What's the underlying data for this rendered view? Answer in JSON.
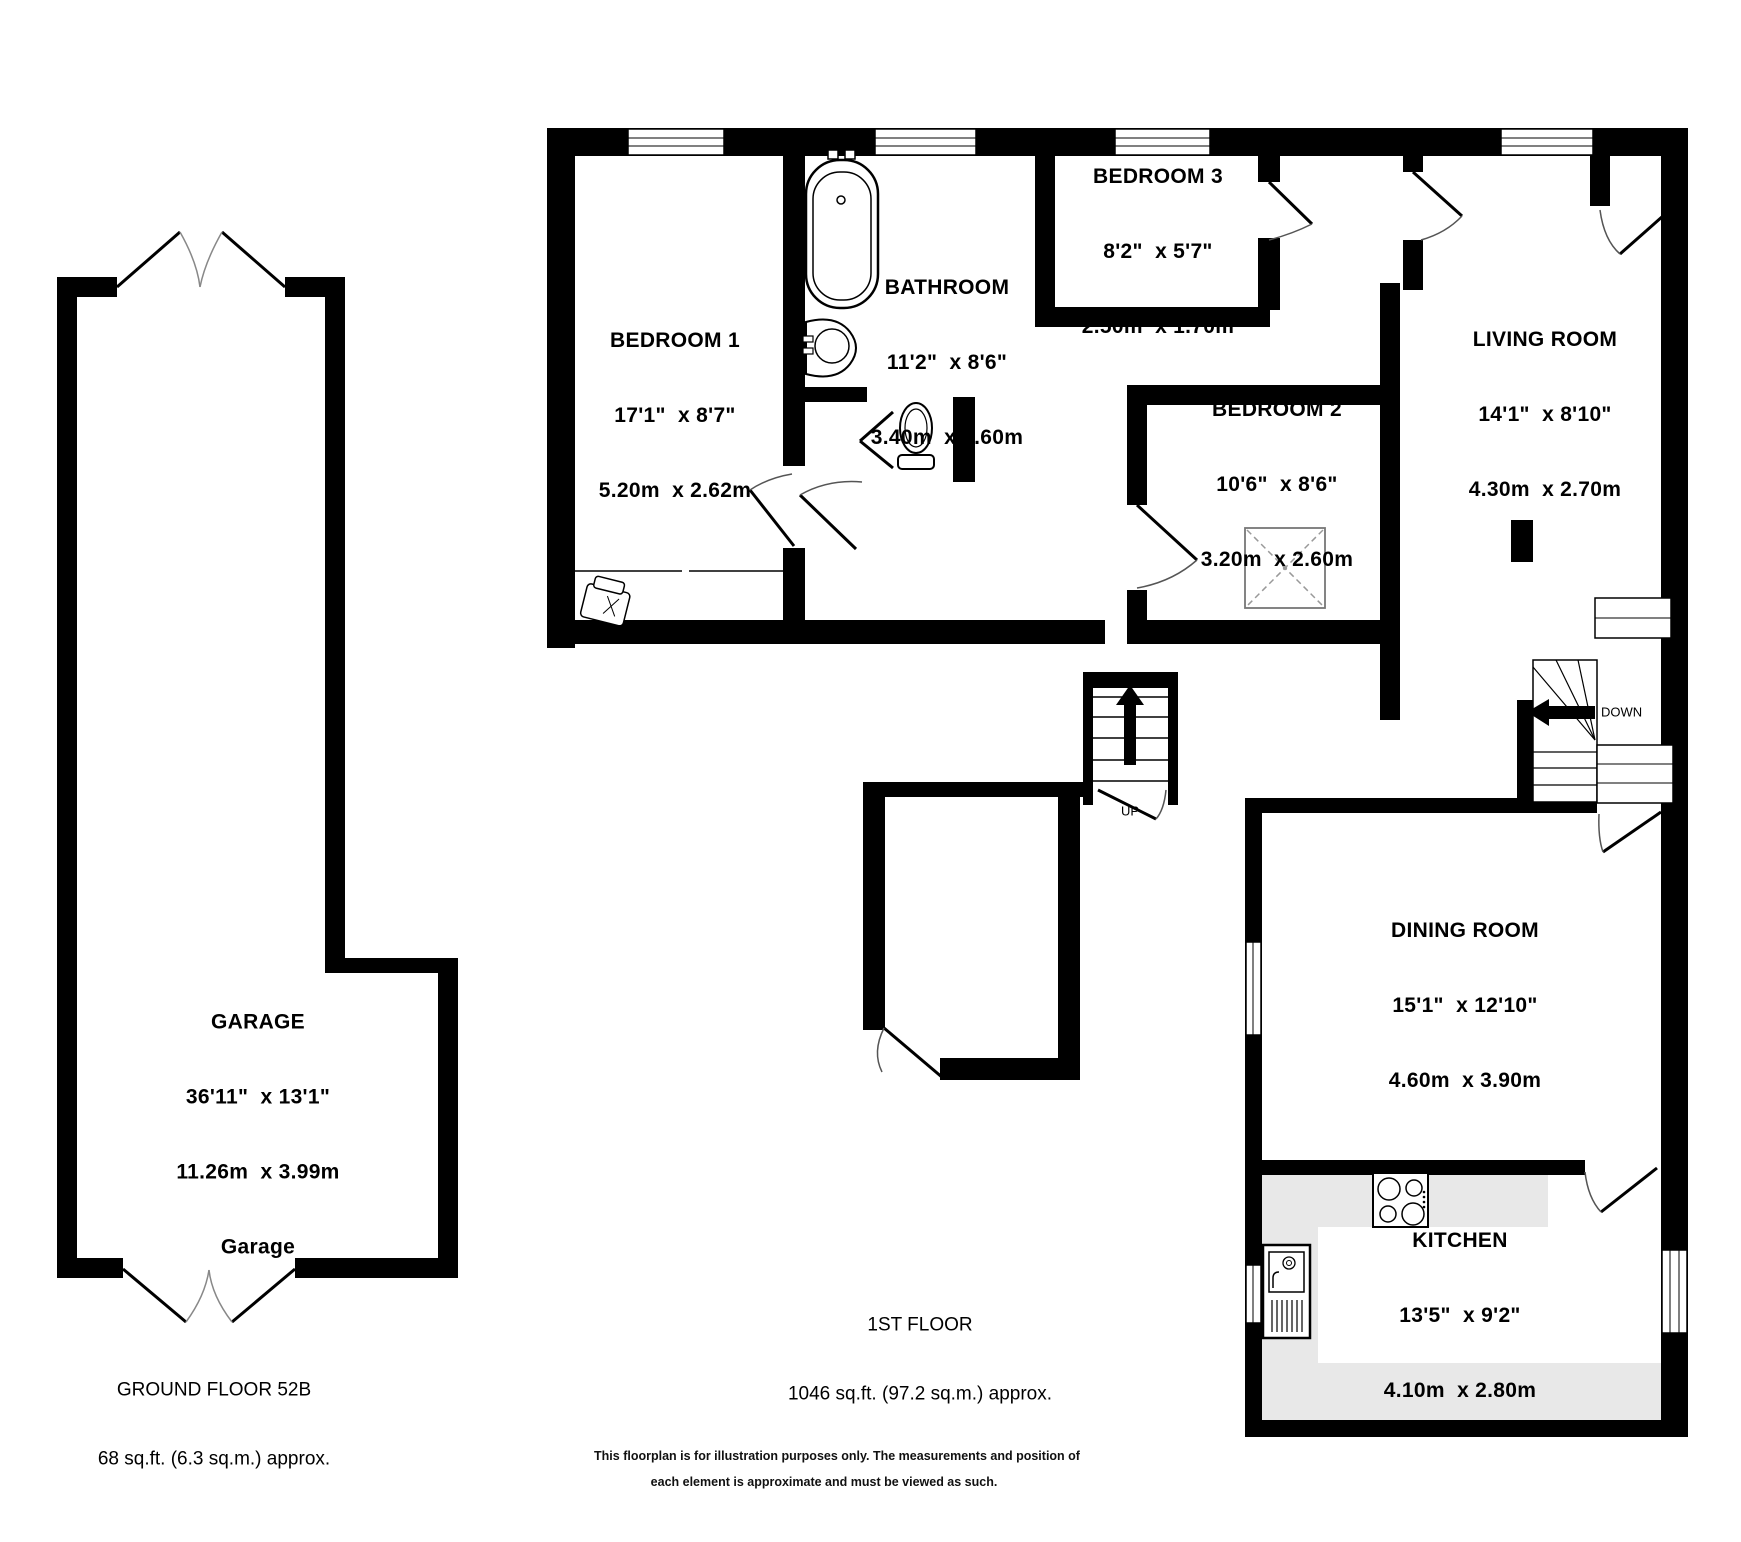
{
  "rooms": {
    "bedroom1": {
      "name": "BEDROOM 1",
      "imperial": "17'1\"  x 8'7\"",
      "metric": "5.20m  x 2.62m"
    },
    "bathroom": {
      "name": "BATHROOM",
      "imperial": "11'2\"  x 8'6\"",
      "metric": "3.40m  x 2.60m"
    },
    "bedroom3": {
      "name": "BEDROOM 3",
      "imperial": "8'2\"  x 5'7\"",
      "metric": "2.50m  x 1.70m"
    },
    "bedroom2": {
      "name": "BEDROOM 2",
      "imperial": "10'6\"  x 8'6\"",
      "metric": "3.20m  x 2.60m"
    },
    "living": {
      "name": "LIVING ROOM",
      "imperial": "14'1\"  x 8'10\"",
      "metric": "4.30m  x 2.70m"
    },
    "dining": {
      "name": "DINING ROOM",
      "imperial": "15'1\"  x 12'10\"",
      "metric": "4.60m  x 3.90m"
    },
    "kitchen": {
      "name": "KITCHEN",
      "imperial": "13'5\"  x 9'2\"",
      "metric": "4.10m  x 2.80m"
    },
    "garage": {
      "name": "GARAGE",
      "imperial": "36'11\"  x 13'1\"",
      "metric": "11.26m  x 3.99m",
      "sub": "Garage"
    }
  },
  "stairs": {
    "up": "UP",
    "down": "DOWN"
  },
  "floors": {
    "first": {
      "label": "1ST FLOOR",
      "area": "1046 sq.ft. (97.2 sq.m.) approx."
    },
    "ground": {
      "label": "GROUND FLOOR 52B",
      "area": "68 sq.ft. (6.3 sq.m.) approx."
    }
  },
  "disclaimer": {
    "line1": "This floorplan is for illustration purposes only. The measurements and position of",
    "line2": "each element is approximate and must be viewed as such."
  },
  "colors": {
    "wall": "#000000",
    "counter": "#e8e8e8",
    "background": "#ffffff"
  }
}
